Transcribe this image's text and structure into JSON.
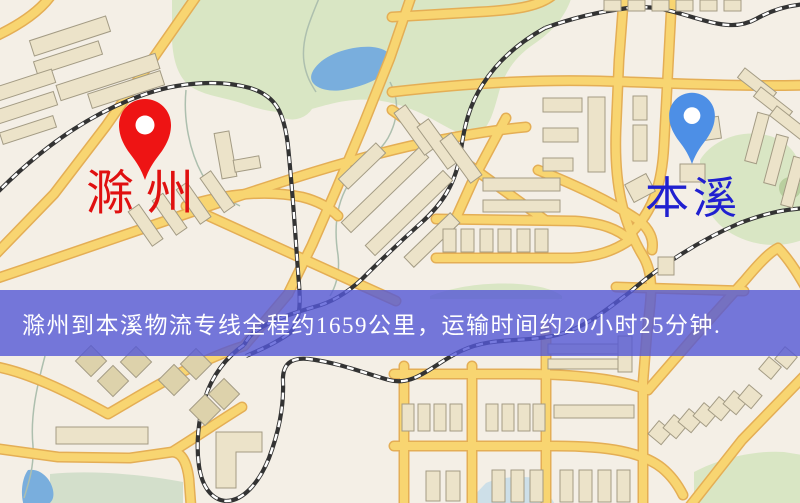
{
  "map": {
    "origin": {
      "label": "滁州",
      "label_color": "#e01010",
      "pin_color": "#ee1414"
    },
    "destination": {
      "label": "本溪",
      "label_color": "#2020d0",
      "pin_color": "#4d8fe6"
    },
    "banner": {
      "text": "滁州到本溪物流专线全程约1659公里，运输时间约20小时25分钟.",
      "background": "rgba(84,88,214,0.8)",
      "text_color": "#ffffff"
    },
    "route": {
      "distance_km": "1659",
      "duration": "20小时25分钟"
    },
    "colors": {
      "background": "#f4efe6",
      "road": "#f8d571",
      "road_casing": "#e4ae55",
      "park": "#d9e6c4",
      "water": "#79aedd",
      "building": "#ece3c9",
      "building_stroke": "#a39b84",
      "railway": "#333333"
    }
  }
}
